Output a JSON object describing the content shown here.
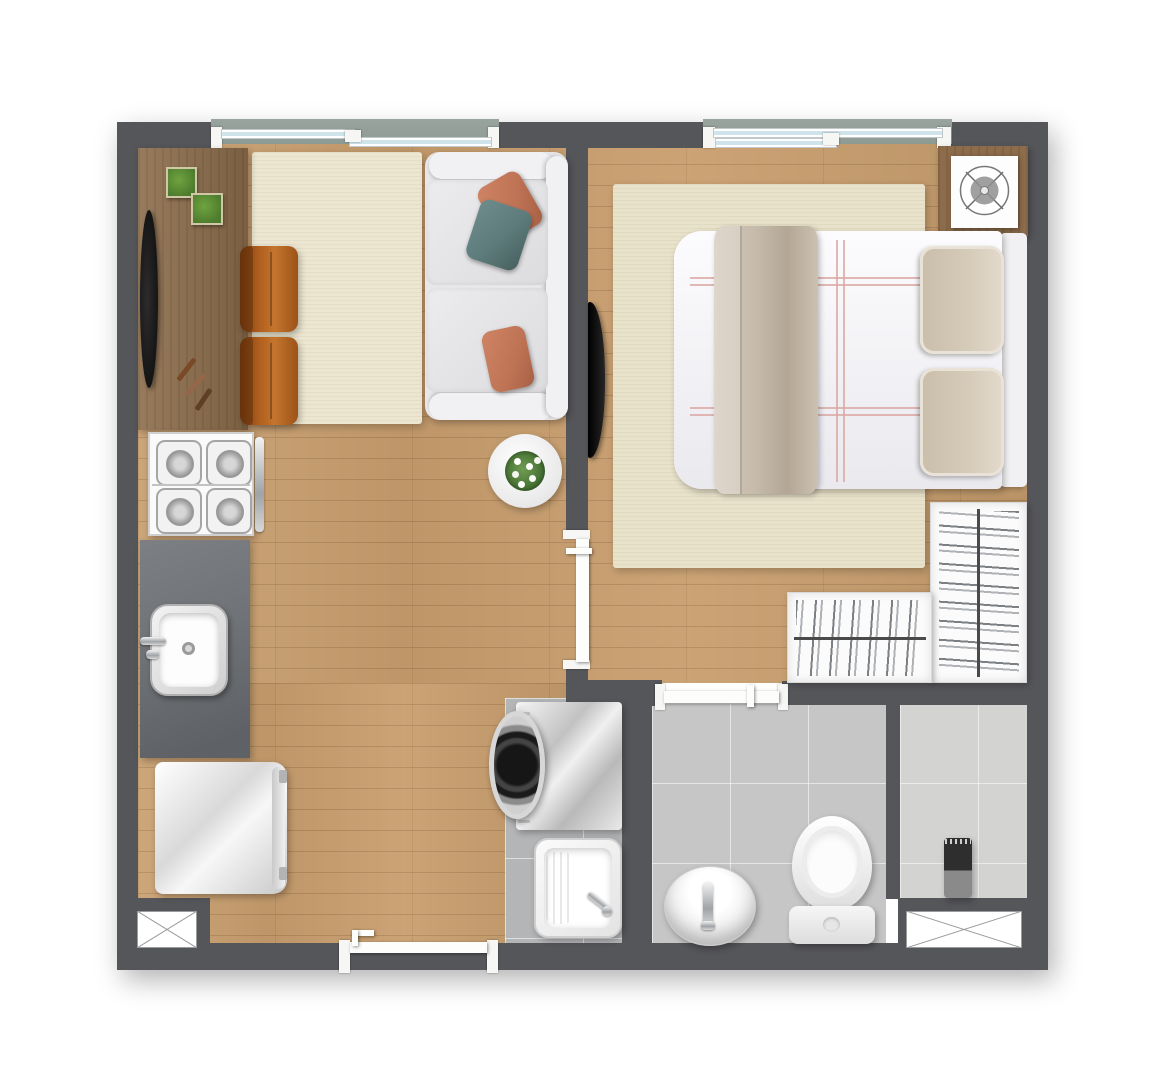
{
  "meta": {
    "type": "apartment-floor-plan",
    "view": "top-down-rendered",
    "text_labels_visible": "none"
  },
  "palette": {
    "wall": "#55565a",
    "wood": "#c89e6e",
    "sideboard": "#8c6c4a",
    "ruglive": "#ece6d0",
    "rugbed": "#e9e2ca",
    "sofa": "#e7e7e9",
    "sofalight": "#f1f1f3",
    "orange": "#bf7355",
    "teal": "#5d7b7b",
    "chair": "#b2601f",
    "counter": "#6f7276",
    "steel": "#d9d9d9",
    "tilebath": "#c6c6c6",
    "tilelaundry": "#b4b5b7",
    "tileshower": "#d3d3d1",
    "fixture": "#f7f7f7",
    "glass": "#cfe4ea",
    "exterior": "#8e9a94",
    "plant": "#4d7c2e",
    "black": "#151515",
    "blanket": "#c6bbab",
    "bedpillow": "#d5cab8",
    "stripe": "#dba8a2"
  },
  "rooms": [
    {
      "id": "living-room",
      "floor": "wood",
      "furniture": [
        "sideboard",
        "tv",
        "plant-pot",
        "plant-pot",
        "remote-controls",
        "area-rug",
        "lounge-chair",
        "lounge-chair",
        "two-seat-sofa",
        "throw-pillow-orange",
        "throw-pillow-teal",
        "throw-pillow-orange",
        "round-coffee-table-with-flowers"
      ]
    },
    {
      "id": "kitchen",
      "floor": "wood",
      "furniture": [
        "cooktop-4-burner",
        "countertop",
        "kitchen-sink",
        "refrigerator"
      ]
    },
    {
      "id": "bedroom",
      "floor": "wood",
      "furniture": [
        "double-bed",
        "blanket-runner",
        "bed-pillow",
        "bed-pillow",
        "headboard",
        "area-rug",
        "wall-mounted-tv",
        "fan-unit-on-stand",
        "l-shaped-wardrobe-with-hangers"
      ]
    },
    {
      "id": "laundry",
      "floor": "tile",
      "furniture": [
        "washing-machine",
        "utility-sink"
      ]
    },
    {
      "id": "bathroom",
      "floor": "tile",
      "furniture": [
        "round-basin",
        "toilet"
      ]
    },
    {
      "id": "shower-room",
      "floor": "tile",
      "furniture": [
        "shower-column"
      ]
    }
  ],
  "openings": {
    "windows": [
      "living-room-sliding-window",
      "bedroom-sliding-window"
    ],
    "doors": [
      "bedroom-door",
      "bathroom-sliding-door",
      "entry-door"
    ],
    "service_shafts": 2
  }
}
